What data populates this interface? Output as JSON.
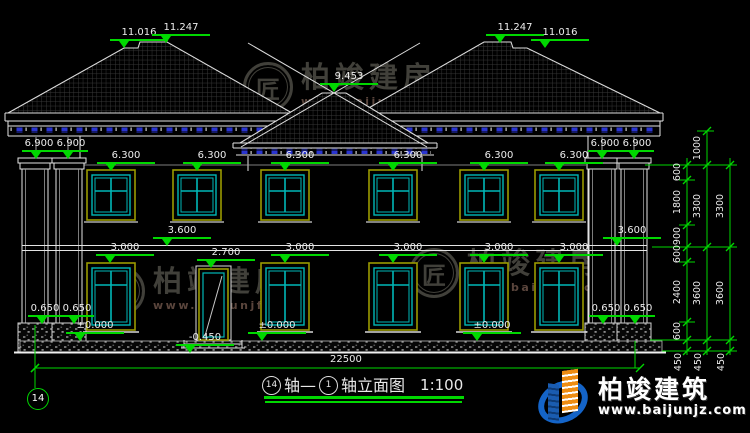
{
  "levels": {
    "ridge_low": "11.016",
    "ridge_high": "11.247",
    "porch_ridge": "9.453",
    "eave": "6.900",
    "upper_window_top": "6.300",
    "floor2": "3.600",
    "lower_window_top": "3.000",
    "door_top": "2.700",
    "zero": "±0.000",
    "plinth_top": "0.650",
    "grade": "-0.450"
  },
  "dims": {
    "total_width": "22500",
    "inner": [
      "600",
      "1800",
      "900",
      "600",
      "2400",
      "600"
    ],
    "middle": [
      "1000",
      "3300",
      "3600"
    ],
    "outer": [
      "3300",
      "3600"
    ],
    "base": "450"
  },
  "axis": {
    "left_bubble": "14"
  },
  "title": {
    "bubble_left": "14",
    "axis_word": "轴—",
    "bubble_right": "1",
    "name": "轴立面图",
    "scale": "1:100"
  },
  "watermark": {
    "monogram": "匠",
    "name": "柏竣建房",
    "url": "www.baijunjf.com"
  },
  "brand": {
    "name": "柏竣建筑",
    "url": "www.baijunjz.com"
  },
  "colors": {
    "background": "#000000",
    "line": "#e4e4e4",
    "dimension_green": "#00d800",
    "window_teal": "#00b8b8",
    "frame_olive": "#9a9a00",
    "fascia_blue": "#2a35d0"
  }
}
